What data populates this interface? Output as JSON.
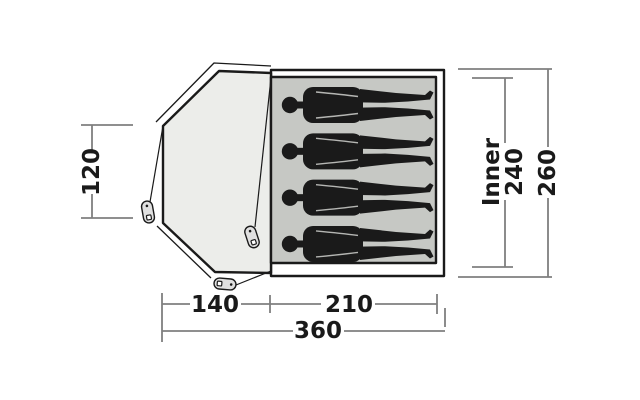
{
  "diagram": {
    "kind": "tent-floorplan-top-view",
    "labels": {
      "porch_height": "120",
      "porch_depth": "140",
      "inner_depth": "210",
      "total_depth": "360",
      "inner_prefix": "Inner",
      "inner_width": "240",
      "total_width": "260"
    },
    "occupant_count": 4,
    "colors": {
      "ink": "#1a1a1a",
      "dimension_line": "#7f7f7f",
      "porch_fill": "#ecedea",
      "inner_floor_fill": "#c6c8c4",
      "peg_fill": "#e0e0e0",
      "background": "#ffffff"
    }
  }
}
